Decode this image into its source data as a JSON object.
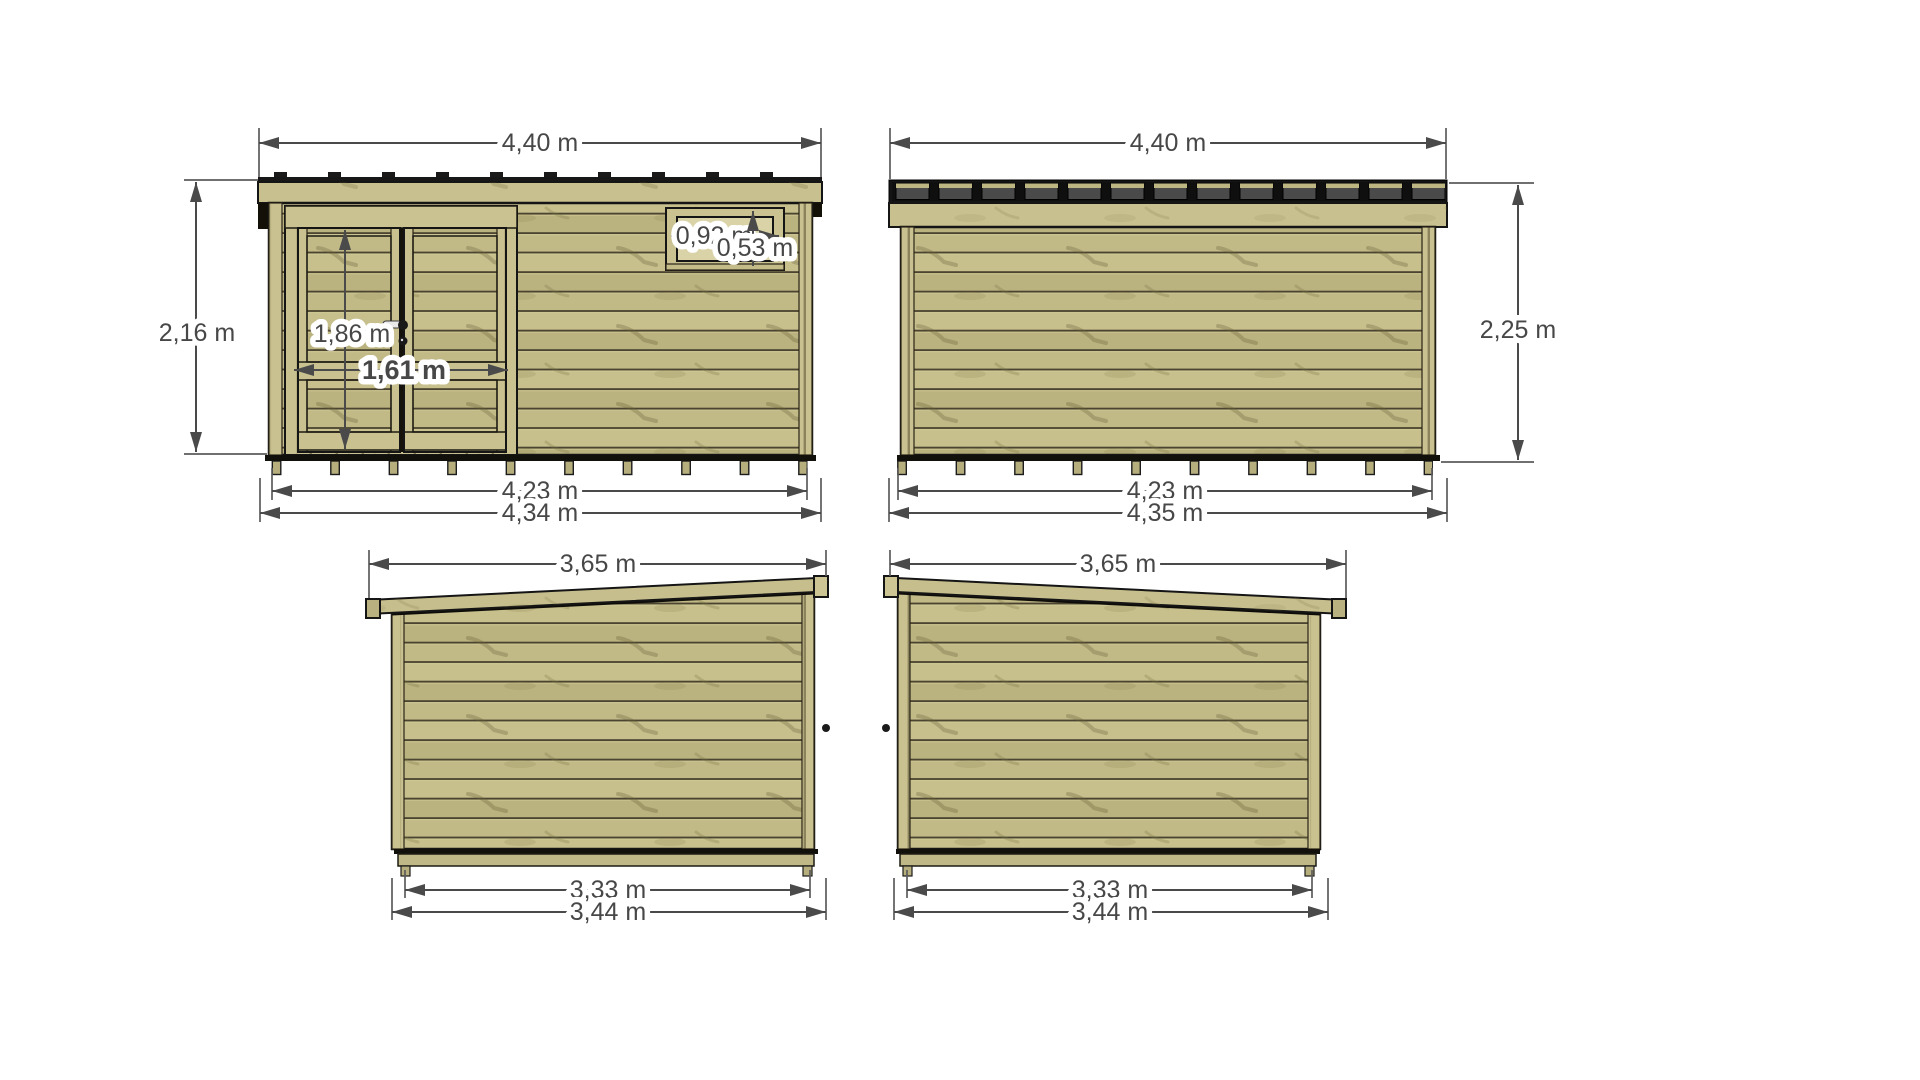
{
  "drawing": {
    "title": "garden-shed-four-elevation-views",
    "background": "#ffffff",
    "colors": {
      "wood_base": "#c1ba87",
      "wood_light": "#c8c08e",
      "wood_trim": "#c9c190",
      "glass": "#dad3a8",
      "outline": "#151515",
      "roof_black": "#141414",
      "roof_panel_gray": "#4a4a4a",
      "dimension": "#4a4a4a"
    },
    "views": {
      "front": {
        "width_top": "4,40 m",
        "height_left": "2,16 m",
        "door_height": "1,86 m",
        "door_width": "1,61 m",
        "window_width": "0,92 m",
        "window_height": "0,53 m",
        "width_inner_bottom": "4,23 m",
        "width_outer_bottom": "4,34 m"
      },
      "back": {
        "width_top": "4,40 m",
        "height_right": "2,25 m",
        "width_inner_bottom": "4,23 m",
        "width_outer_bottom": "4,35 m"
      },
      "left_side": {
        "depth_top": "3,65 m",
        "depth_inner_bottom": "3,33 m",
        "depth_outer_bottom": "3,44 m"
      },
      "right_side": {
        "depth_top": "3,65 m",
        "depth_inner_bottom": "3,33 m",
        "depth_outer_bottom": "3,44 m"
      }
    }
  }
}
